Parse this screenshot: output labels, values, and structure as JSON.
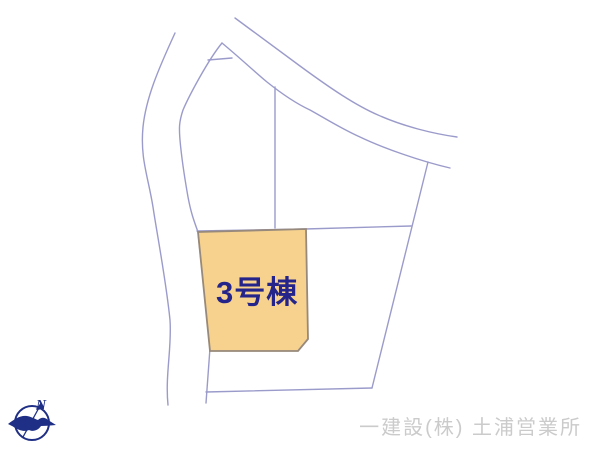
{
  "lot": {
    "label": "3号棟"
  },
  "compass": {
    "north_label": "N"
  },
  "footer": {
    "company": "一建設(株) 土浦営業所"
  },
  "colors": {
    "lot_fill": "#F6D28E",
    "lot_border": "#97897B",
    "parcel_line": "#9B9BCB",
    "lot_label_text": "#24248A",
    "compass": "#1F2F85",
    "footer_text": "#CBCBCB",
    "background": "#FFFFFF"
  }
}
